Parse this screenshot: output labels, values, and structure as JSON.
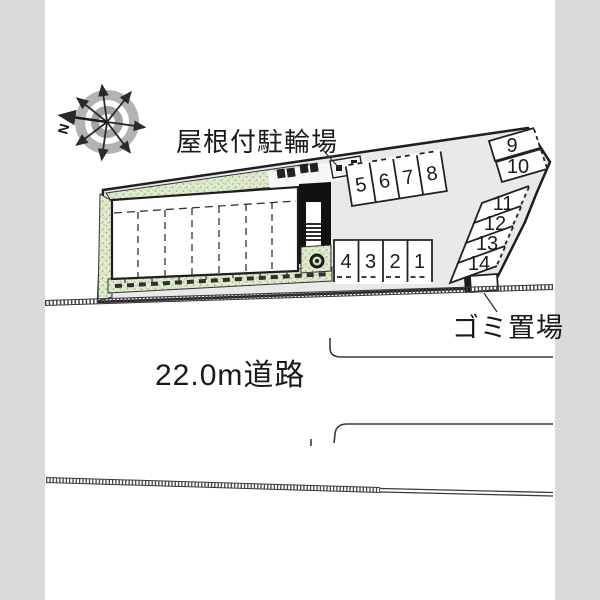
{
  "compass": {
    "label": "N"
  },
  "labels": {
    "bicycle_parking": "屋根付駐輪場",
    "garbage": "ゴミ置場",
    "road": "22.0m道路"
  },
  "parking": {
    "top_row": [
      "5",
      "6",
      "7",
      "8"
    ],
    "bottom_row": [
      "4",
      "3",
      "2",
      "1"
    ],
    "right_upper": [
      "9",
      "10"
    ],
    "right_lower": [
      "11",
      "12",
      "13",
      "14"
    ]
  },
  "colors": {
    "page_margin": "#dadada",
    "site_fill": "#e9e9e9",
    "vegetation": "#dfecd0",
    "outline": "#1e1e1e"
  }
}
